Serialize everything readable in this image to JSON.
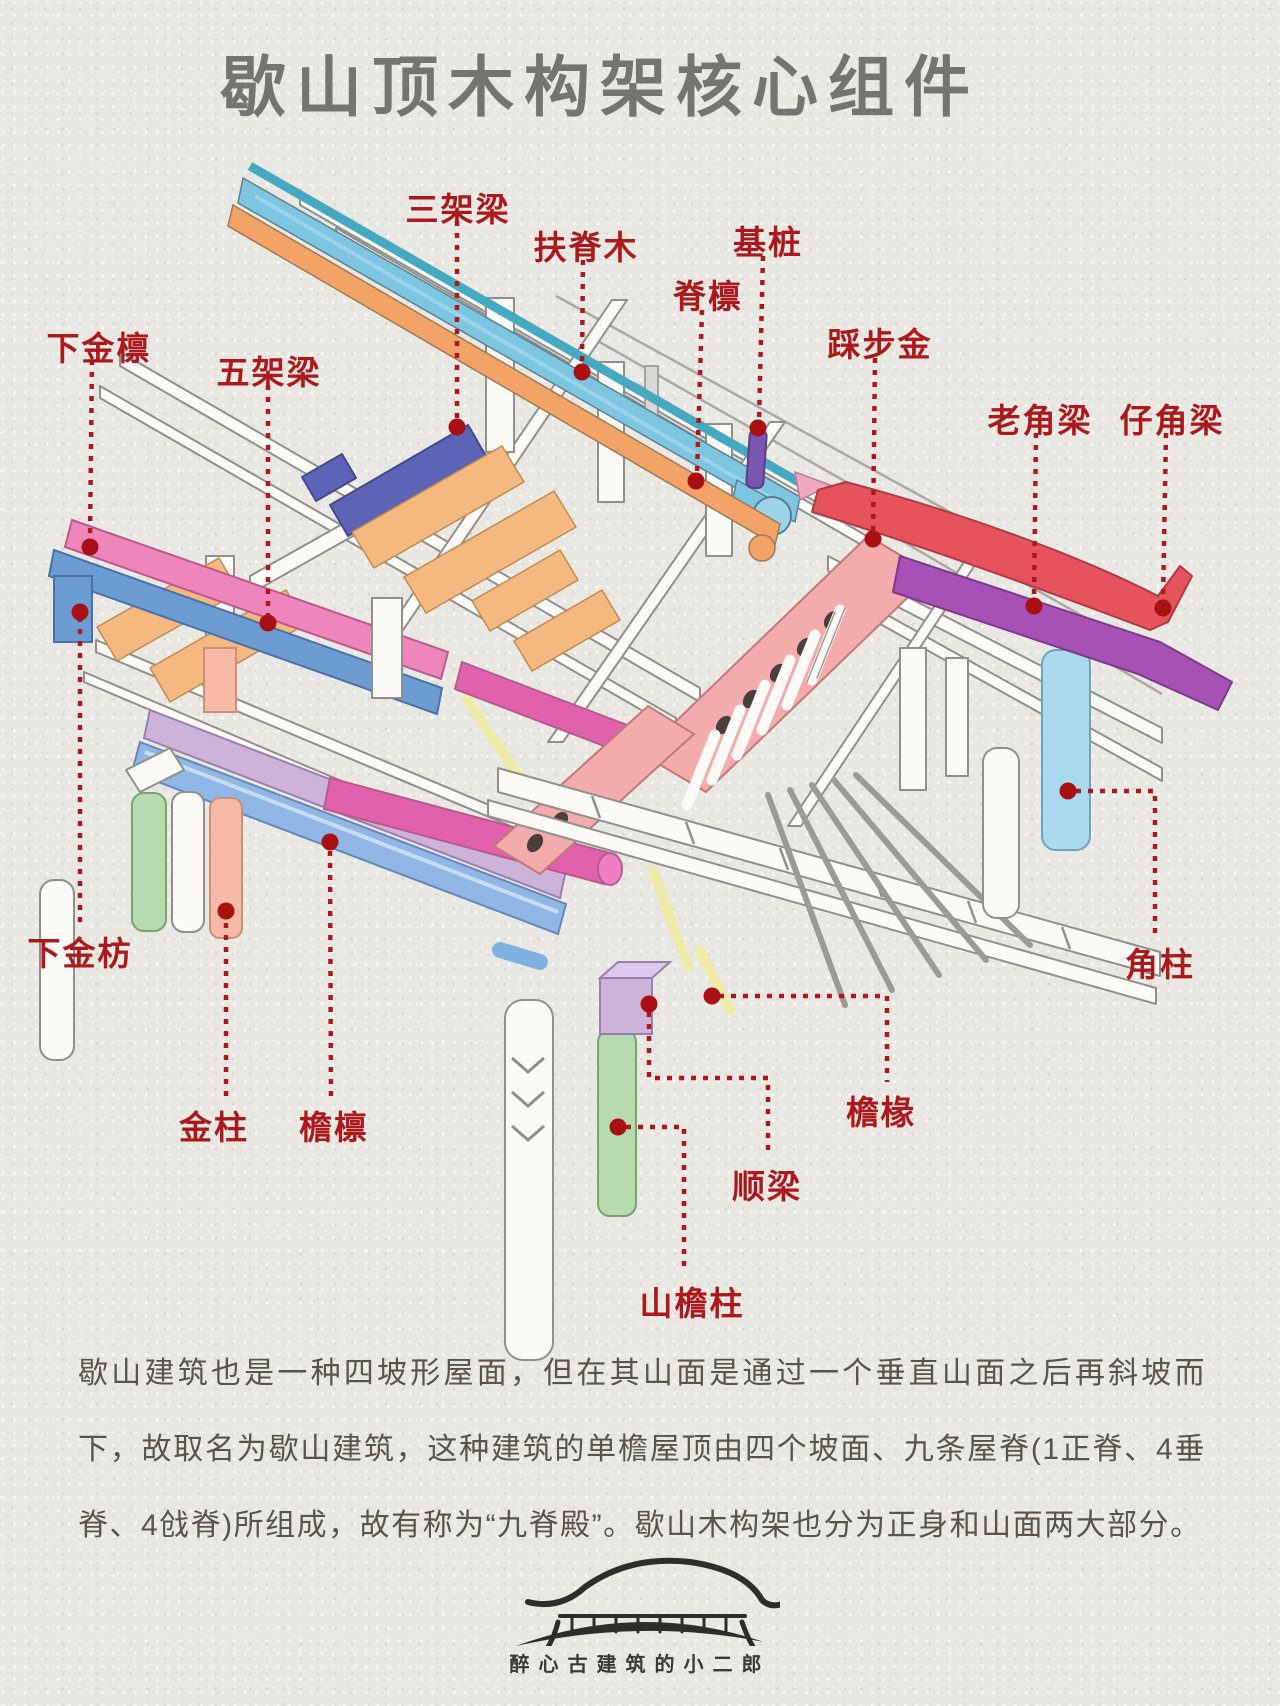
{
  "title": "歇山顶木构架核心组件",
  "labels": [
    {
      "id": "xiajinlin",
      "text": "下金檩"
    },
    {
      "id": "wujialiang",
      "text": "五架梁"
    },
    {
      "id": "sanjialiang",
      "text": "三架梁"
    },
    {
      "id": "fujimu",
      "text": "扶脊木"
    },
    {
      "id": "jilin",
      "text": "脊檩"
    },
    {
      "id": "jizhuang",
      "text": "基桩"
    },
    {
      "id": "caibujin",
      "text": "踩步金"
    },
    {
      "id": "laojiaoliang",
      "text": "老角梁"
    },
    {
      "id": "zijiaoliang",
      "text": "仔角梁"
    },
    {
      "id": "xiajinfang",
      "text": "下金枋"
    },
    {
      "id": "jinzhu",
      "text": "金柱"
    },
    {
      "id": "yanlin",
      "text": "檐檩"
    },
    {
      "id": "jiaozhu",
      "text": "角柱"
    },
    {
      "id": "yanchuan",
      "text": "檐椽"
    },
    {
      "id": "shunliang",
      "text": "顺梁"
    },
    {
      "id": "shanyanzhu",
      "text": "山檐柱"
    }
  ],
  "paragraph": "歇山建筑也是一种四坡形屋面，但在其山面是通过一个垂直山面之后再斜坡而下，故取名为歇山建筑，这种建筑的单檐屋顶由四个坡面、九条屋脊(1正脊、4垂脊、4戗脊)所组成，故有称为“九脊殿”。歇山木构架也分为正身和山面两大部分。",
  "footer": {
    "brand": "醉心古建筑的小二郎"
  },
  "palette": {
    "label-red": "#ac191d",
    "dot-red": "#a81014",
    "title-gray": "#767470",
    "text-gray": "#57544d",
    "beam-teal": "#45a9c2",
    "beam-cyan": "#7cc6e1",
    "beam-cyan-light": "#9bd4ea",
    "beam-orange": "#f2a365",
    "beam-orange-flat": "#f5b87e",
    "beam-indigo": "#5d64b6",
    "beam-pink": "#ef86bb",
    "beam-magenta": "#e161ad",
    "beam-blue": "#6b9cd2",
    "beam-lavender": "#cdb2da",
    "beam-steelblue": "#8fb6e4",
    "slab-salmon": "#f3abab",
    "pillar-green": "#b5dbae",
    "pillar-salmon": "#f6b9a5",
    "pillar-blue": "#aadaee",
    "beam-red": "#e6535d",
    "beam-purple": "#a751b7",
    "peg-purple": "#7b55b2",
    "rafter-yellow": "#eeeaa8"
  },
  "color_coding": [
    {
      "part": "脊檩/扶脊木",
      "color_key": "beam-cyan"
    },
    {
      "part": "三架梁",
      "color_key": "beam-indigo"
    },
    {
      "part": "五架梁",
      "color_key": "beam-orange-flat"
    },
    {
      "part": "下金檩",
      "color_key": "beam-pink"
    },
    {
      "part": "下金枋",
      "color_key": "beam-blue"
    },
    {
      "part": "檐檩",
      "color_key": "beam-steelblue"
    },
    {
      "part": "踩步金",
      "color_key": "slab-salmon"
    },
    {
      "part": "仔角梁",
      "color_key": "beam-red"
    },
    {
      "part": "老角梁",
      "color_key": "beam-purple"
    },
    {
      "part": "基桩",
      "color_key": "peg-purple"
    },
    {
      "part": "檐椽",
      "color_key": "rafter-yellow"
    },
    {
      "part": "金柱",
      "color_key": "pillar-salmon"
    },
    {
      "part": "角柱",
      "color_key": "pillar-blue"
    },
    {
      "part": "山檐柱",
      "color_key": "pillar-green"
    }
  ]
}
